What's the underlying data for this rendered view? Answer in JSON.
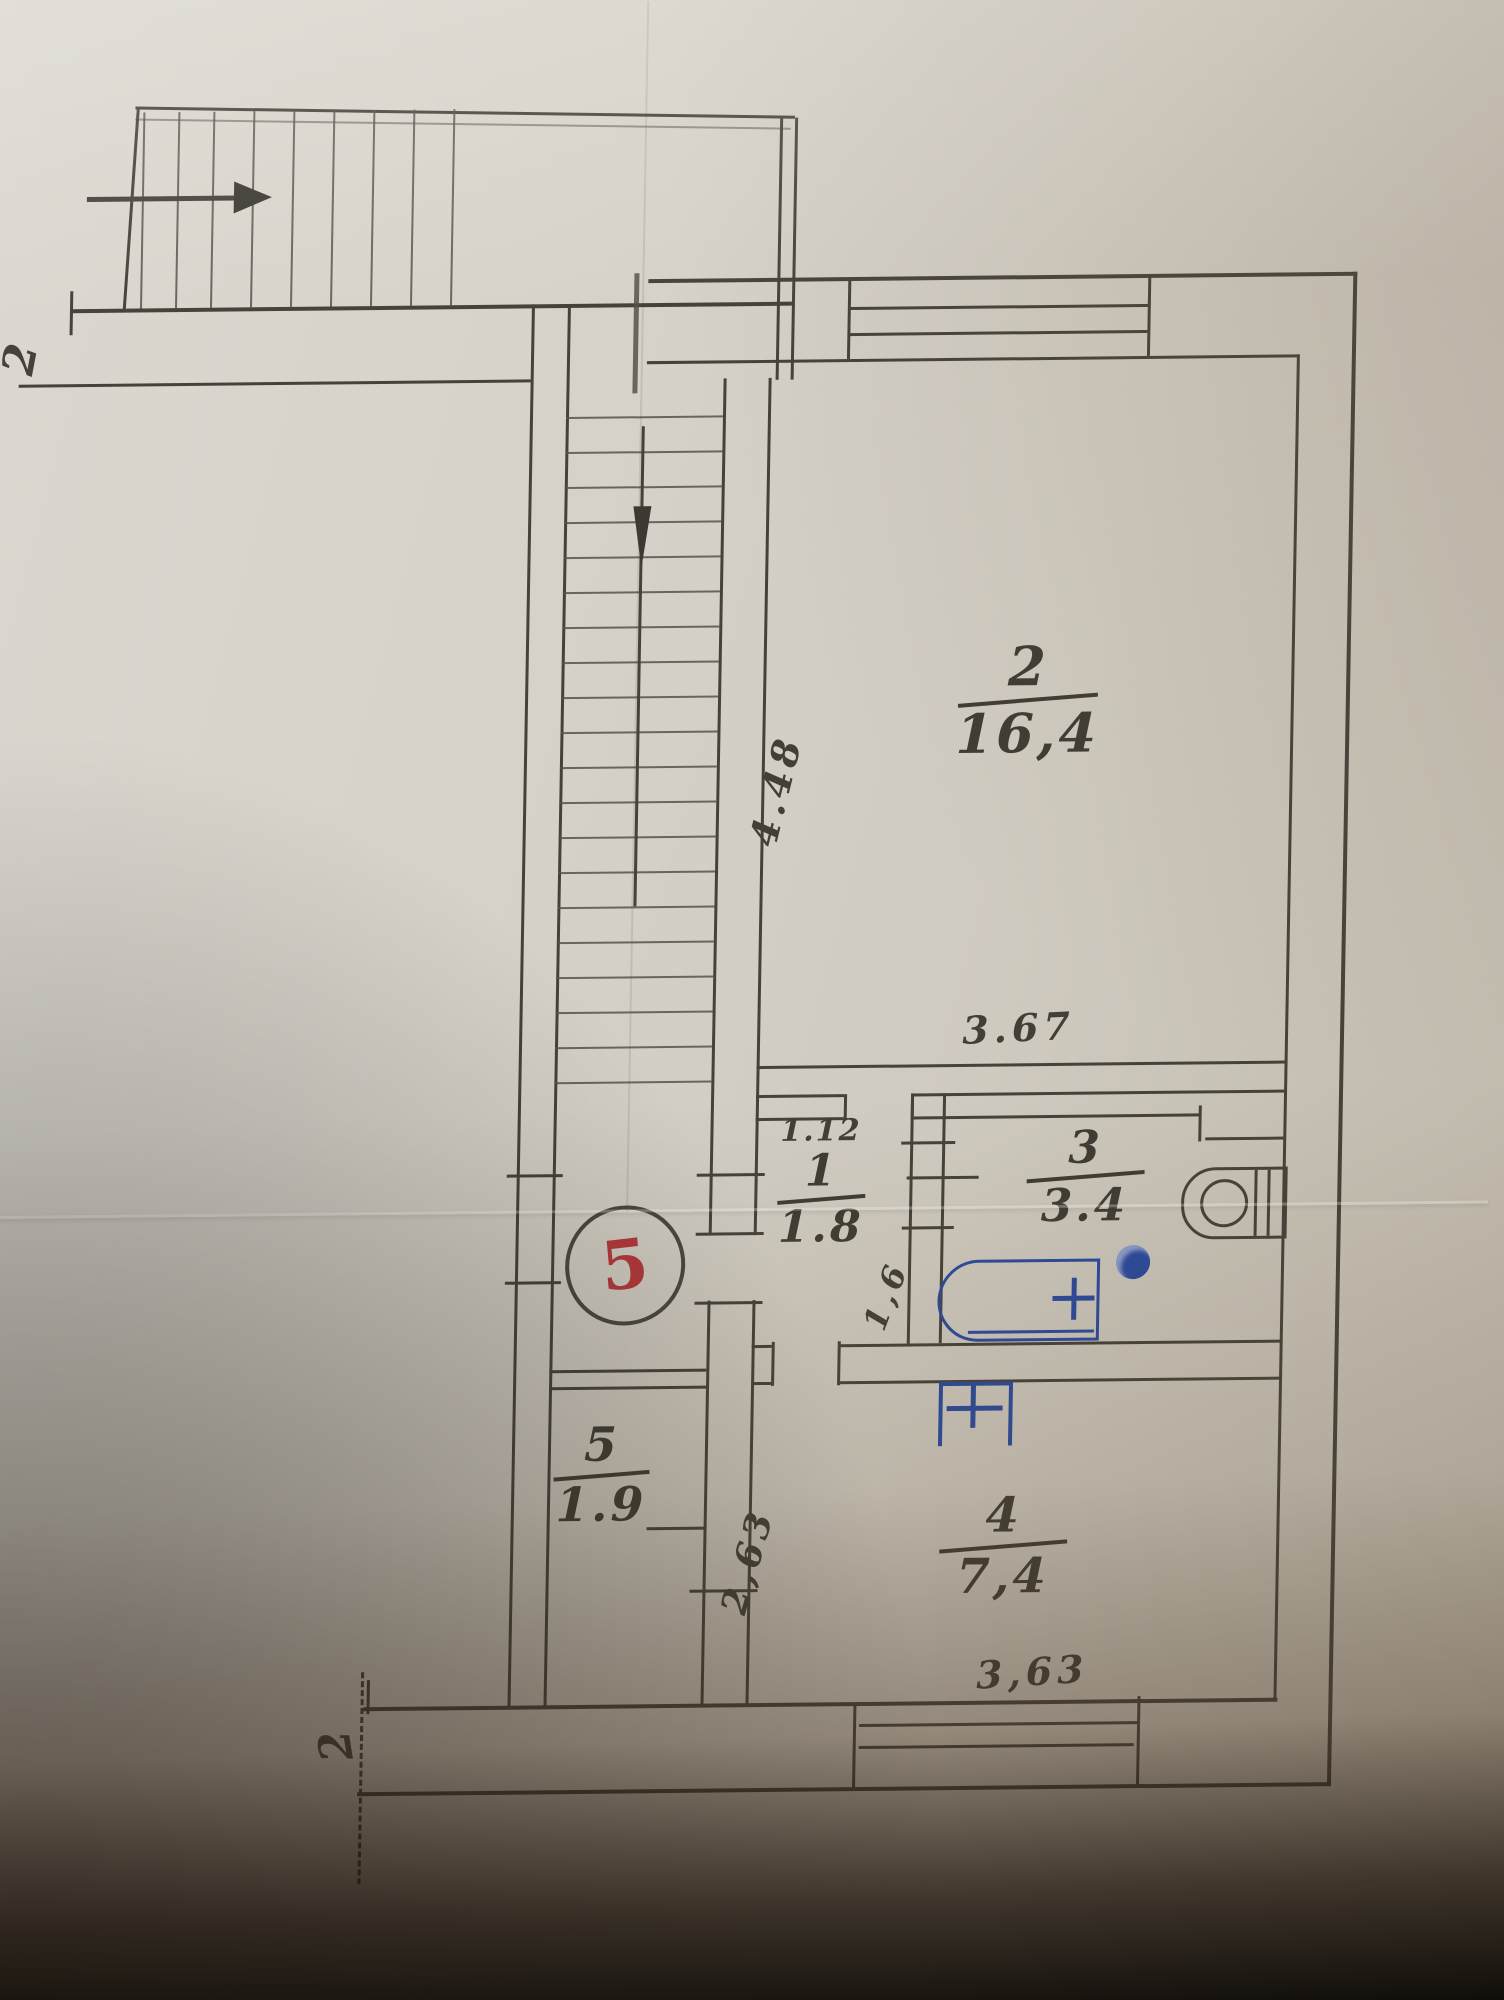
{
  "photo": {
    "description": "hand-drawn apartment floor plan on creased paper"
  },
  "badge": {
    "apartment_number": "5"
  },
  "rooms": {
    "living": {
      "number": "2",
      "area": "16,4"
    },
    "hall": {
      "number": "1",
      "area": "1.8"
    },
    "bath": {
      "number": "3",
      "area": "3.4"
    },
    "kitchen": {
      "number": "4",
      "area": "7,4"
    },
    "storage": {
      "number": "5",
      "area": "1.9"
    }
  },
  "dimensions": {
    "stairwell_depth": "4.48",
    "living_width": "3.67",
    "hall_width": "1.12",
    "bath_hall_depth": "1,6",
    "corridor_depth": "2,63",
    "kitchen_width": "3,63"
  },
  "axis_marks": {
    "top_left": "2",
    "bottom_left": "2"
  },
  "colors": {
    "pencil": "#45423a",
    "ink_blue": "#2b4a9b",
    "stamp_red": "#b5373a",
    "paper": "#d5d1c8"
  },
  "stairs": {
    "entry_treads": 9,
    "shaft_treads": 20
  }
}
